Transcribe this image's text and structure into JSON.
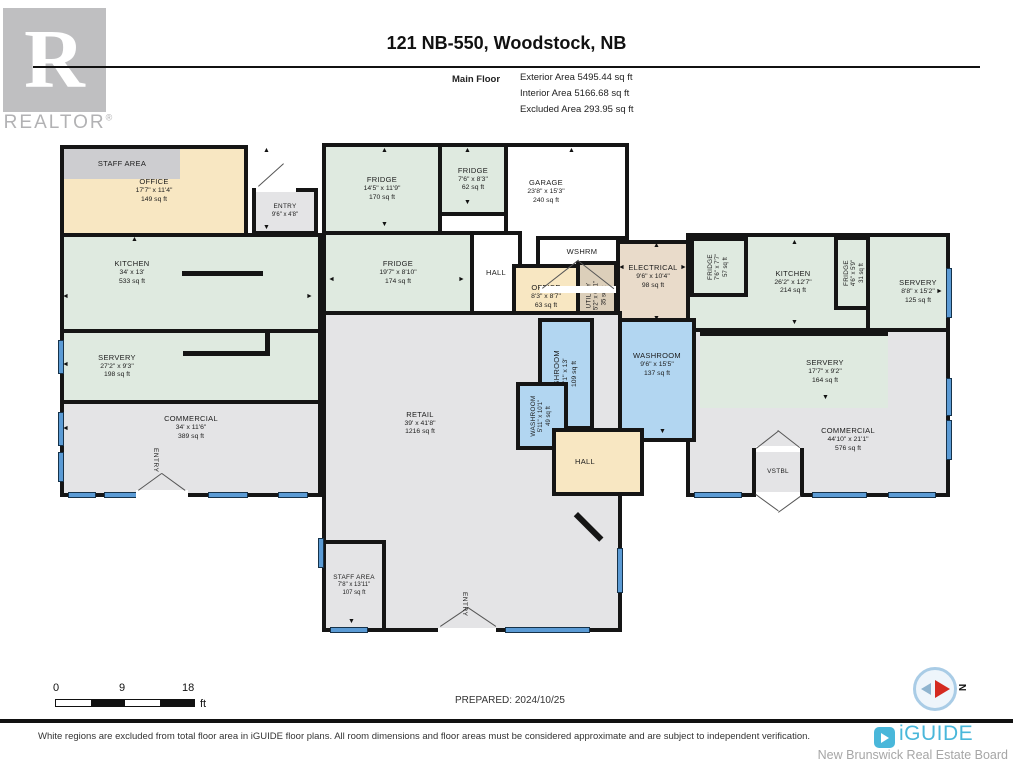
{
  "header": {
    "realtor_r": "R",
    "realtor_text": "REALTOR",
    "realtor_reg": "®",
    "title": "121 NB-550, Woodstock, NB",
    "floor_label": "Main Floor",
    "stats": [
      "Exterior Area 5495.44 sq ft",
      "Interior Area 5166.68 sq ft",
      "Excluded Area 293.95 sq ft"
    ]
  },
  "icons": {
    "up": "▲",
    "down": "▼",
    "left": "◄",
    "right": "►"
  },
  "rooms": {
    "staff_area_1": {
      "name": "STAFF AREA"
    },
    "office_1": {
      "name": "OFFICE",
      "dims": "17'7\" x 11'4\"",
      "area": "149 sq ft"
    },
    "entry_1": {
      "name": "ENTRY",
      "dims": "9'6\" x 4'8\""
    },
    "kitchen_1": {
      "name": "KITCHEN",
      "dims": "34' x 13'",
      "area": "533 sq ft"
    },
    "servery_1": {
      "name": "SERVERY",
      "dims": "27'2\" x 9'3\"",
      "area": "198 sq ft"
    },
    "commercial_1": {
      "name": "COMMERCIAL",
      "dims": "34' x 11'6\"",
      "area": "389 sq ft"
    },
    "fridge_1": {
      "name": "FRIDGE",
      "dims": "14'5\" x 11'9\"",
      "area": "170 sq ft"
    },
    "fridge_2": {
      "name": "FRIDGE",
      "dims": "7'6\" x 8'3\"",
      "area": "62 sq ft"
    },
    "garage": {
      "name": "GARAGE",
      "dims": "23'8\" x 15'3\"",
      "area": "240 sq ft"
    },
    "wshrm": {
      "name": "WSHRM"
    },
    "fridge_3": {
      "name": "FRIDGE",
      "dims": "19'7\" x 8'10\"",
      "area": "174 sq ft"
    },
    "hall_1": {
      "name": "HALL"
    },
    "office_2": {
      "name": "OFFICE",
      "dims": "8'3\" x 8'7\"",
      "area": "63 sq ft"
    },
    "utility": {
      "name": "UTILITY",
      "dims": "5'2\" x 6'11\"",
      "area": "35 sq ft"
    },
    "electrical": {
      "name": "ELECTRICAL",
      "dims": "9'6\" x 10'4\"",
      "area": "98 sq ft"
    },
    "fridge_4": {
      "name": "FRIDGE",
      "dims": "7'6\" x 7'7\"",
      "area": "57 sq ft"
    },
    "kitchen_2": {
      "name": "KITCHEN",
      "dims": "26'2\" x 12'7\"",
      "area": "214 sq ft"
    },
    "fridge_5": {
      "name": "FRIDGE",
      "dims": "4'6\" x 5'9\"",
      "area": "31 sq ft"
    },
    "servery_2": {
      "name": "SERVERY",
      "dims": "8'8\" x 15'2\"",
      "area": "125 sq ft"
    },
    "washroom_1": {
      "name": "WASHROOM",
      "dims": "10'1\" x 13'",
      "area": "109 sq ft"
    },
    "washroom_2": {
      "name": "WASHROOM",
      "dims": "9'6\" x 15'5\"",
      "area": "137 sq ft"
    },
    "washroom_3": {
      "name": "WASHROOM",
      "dims": "5'11\" x 10'1\"",
      "area": "49 sq ft"
    },
    "hall_2": {
      "name": "HALL"
    },
    "retail": {
      "name": "RETAIL",
      "dims": "39' x 41'8\"",
      "area": "1216 sq ft"
    },
    "staff_area_2": {
      "name": "STAFF AREA",
      "dims": "7'8\" x 13'11\"",
      "area": "107 sq ft"
    },
    "servery_3": {
      "name": "SERVERY",
      "dims": "17'7\" x 9'2\"",
      "area": "164 sq ft"
    },
    "commercial_2": {
      "name": "COMMERCIAL",
      "dims": "44'10\" x 21'1\"",
      "area": "576 sq ft"
    },
    "vstbl": {
      "name": "VSTBL"
    },
    "entry_door_left": {
      "name": "ENTRY"
    },
    "entry_door_bottom": {
      "name": "ENTRY"
    }
  },
  "footer": {
    "scale": {
      "start": "0",
      "mid": "9",
      "end": "18",
      "unit": "ft"
    },
    "prepared": "PREPARED: 2024/10/25",
    "compass_label": "N",
    "disclaimer": "White regions are excluded from total floor area in iGUIDE floor plans. All room dimensions and floor areas must be considered approximate and are subject to independent verification.",
    "brand": "iGUIDE",
    "board": "New Brunswick Real Estate Board"
  }
}
